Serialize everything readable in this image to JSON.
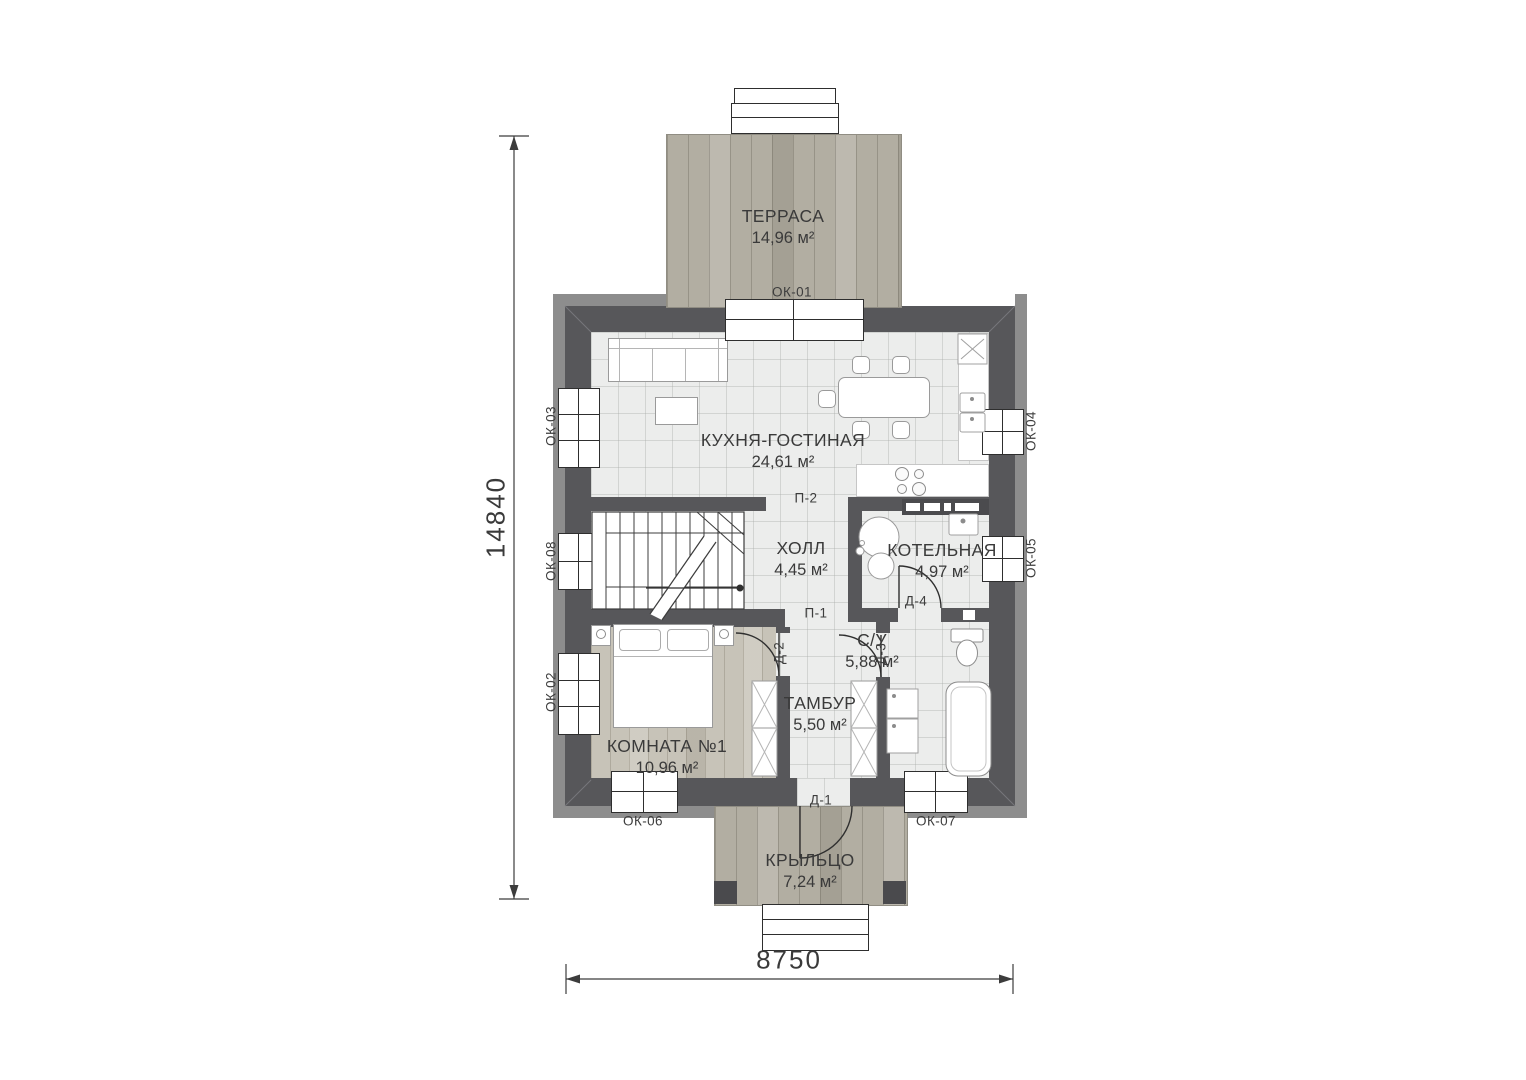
{
  "rooms": [
    {
      "name": "ТЕРРАСА",
      "area": "14,96 м²"
    },
    {
      "name": "КУХНЯ-ГОСТИНАЯ",
      "area": "24,61 м²"
    },
    {
      "name": "ХОЛЛ",
      "area": "4,45 м²"
    },
    {
      "name": "КОТЕЛЬНАЯ",
      "area": "4,97 м²"
    },
    {
      "name": "С/У",
      "area": "5,88 м²"
    },
    {
      "name": "ТАМБУР",
      "area": "5,50 м²"
    },
    {
      "name": "КОМНАТА №1",
      "area": "10,96 м²"
    },
    {
      "name": "КРЫЛЬЦО",
      "area": "7,24 м²"
    }
  ],
  "windows": [
    "ОК-01",
    "ОК-02",
    "ОК-03",
    "ОК-04",
    "ОК-05",
    "ОК-06",
    "ОК-07",
    "ОК-08"
  ],
  "doors": [
    "Д-1",
    "Д-2",
    "Д-3",
    "Д-4"
  ],
  "openings": [
    "П-1",
    "П-2"
  ],
  "dimensions": {
    "height_mm": "14840",
    "width_mm": "8750"
  },
  "colors": {
    "wall": "#57575a",
    "eaves": "#8d8d8d",
    "tile_floor": "#ecedec",
    "wood_room": "#c7c3b8",
    "wood_deck": "#b2aea2",
    "line": "#2e2e2e"
  }
}
